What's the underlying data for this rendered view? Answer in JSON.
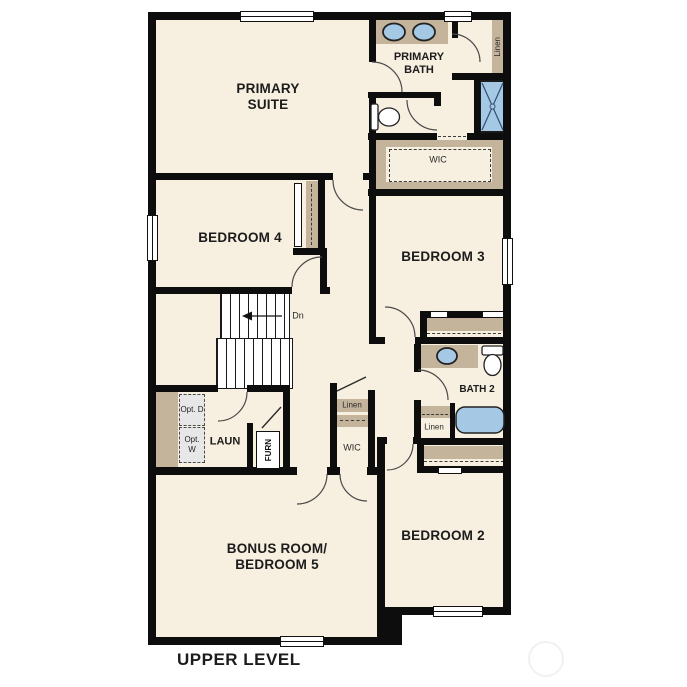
{
  "title": "UPPER LEVEL",
  "colors": {
    "wall": "#0d0d0d",
    "floor": "#f7efdf",
    "casework_tan": "#c4b49b",
    "fixture_blue": "#a5c8e4",
    "door_arc": "#4a4a4a",
    "outside": "#ffffff"
  },
  "rooms": {
    "primary_suite": "PRIMARY SUITE",
    "primary_bath": "PRIMARY BATH",
    "primary_wic": "WIC",
    "linen_primary": "Linen",
    "bedroom_4": "BEDROOM 4",
    "bedroom_3": "BEDROOM 3",
    "bedroom_2": "BEDROOM 2",
    "bonus_room": "BONUS ROOM/ BEDROOM 5",
    "bath_2": "BATH 2",
    "laundry": "LAUN",
    "furnace": "FURN",
    "hall_linen": "Linen",
    "hall_wic": "WIC",
    "bath2_linen": "Linen",
    "opt_dryer": "Opt. D",
    "opt_washer": "Opt. W"
  },
  "stairs": {
    "direction_label": "Dn"
  }
}
